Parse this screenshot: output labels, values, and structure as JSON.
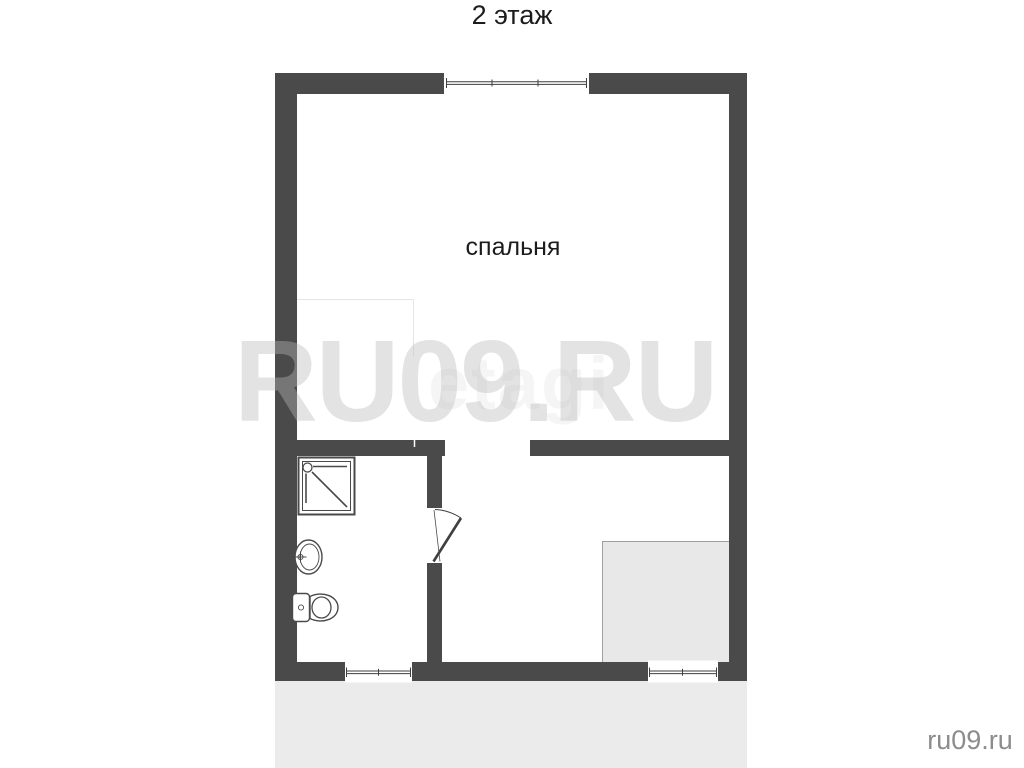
{
  "title": "2 этаж",
  "rooms": {
    "bedroom_label": "спальня"
  },
  "watermarks": {
    "large": "RU09.RU",
    "logo": "etagi",
    "corner": "ru09.ru"
  },
  "colors": {
    "wall": "#4a4a4a",
    "line": "#3f3f3f",
    "floor_background": "#ffffff",
    "lower_area": "#ebebeb",
    "stair_block": "#e8e8e8",
    "stair_block_border": "#a0a0a0",
    "corner_text": "#8c8c8c"
  }
}
